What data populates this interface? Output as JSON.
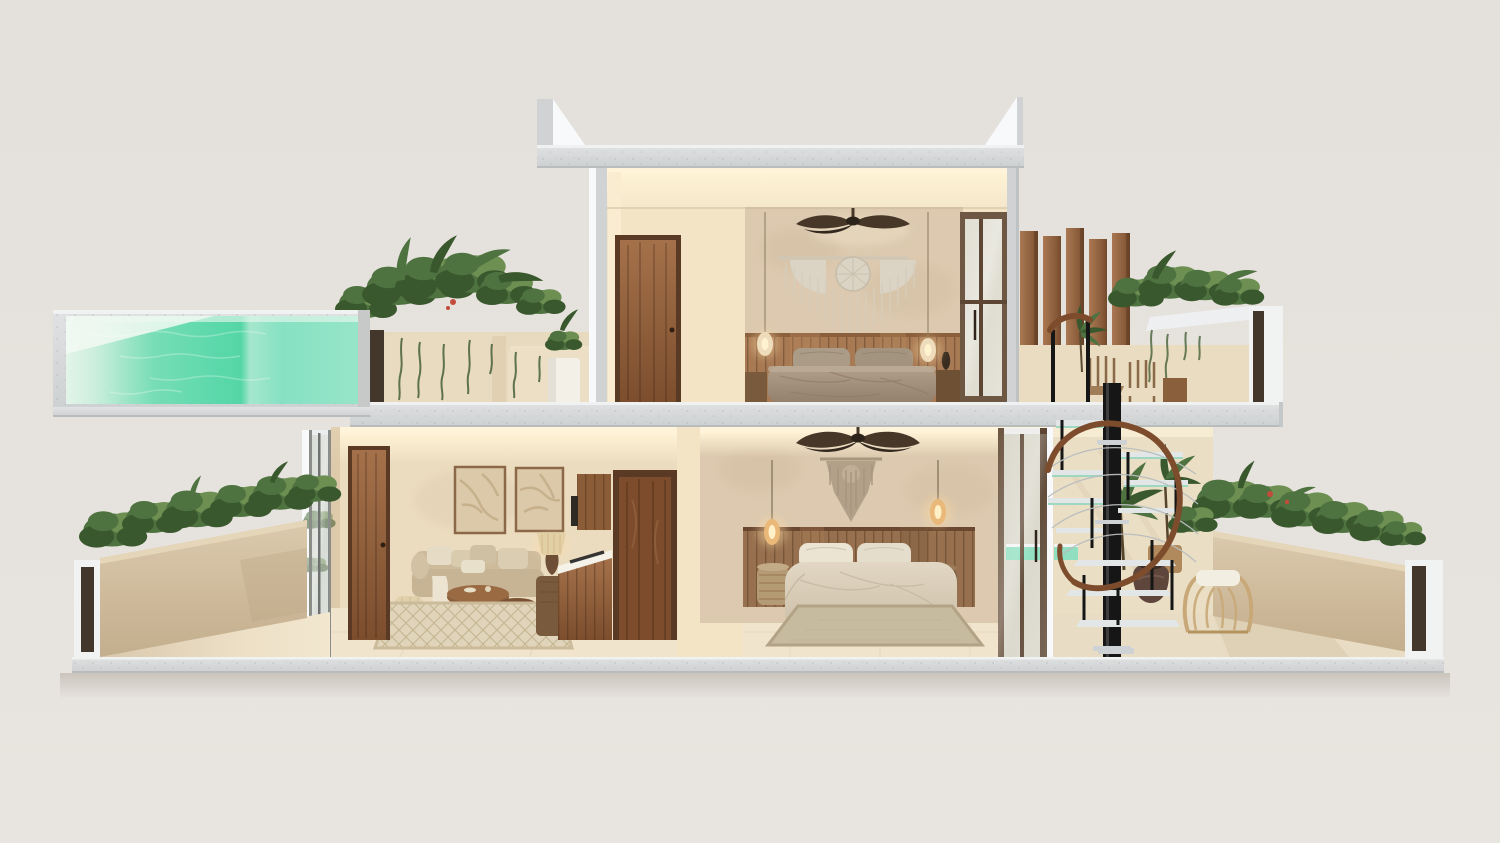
{
  "scene": {
    "type": "architectural-cutaway-render",
    "subject": "Two-story tropical villa cross-section (dollhouse view) on plain warm-gray backdrop",
    "canvas": {
      "width": 1500,
      "height": 843
    },
    "style": "photorealistic render, warm beige plaster, walnut wood, concrete slabs, lush plants",
    "areas": {
      "pool": {
        "label": "Elevated lap pool wing (left, upper level)",
        "objects": [
          "turquoise water",
          "concrete pool shell",
          "light reflection wedge"
        ]
      },
      "upperTerraceLeft": {
        "label": "Upper terrace with planters (left of upper bedroom)",
        "objects": [
          "stucco planter boxes",
          "trailing tropical plants",
          "white plant pot",
          "red flower accents",
          "shadow gap"
        ]
      },
      "upperBedroom": {
        "label": "Upper-floor bedroom (cutaway)",
        "objects": [
          "walnut door",
          "cove-lit ceiling",
          "ceiling fan",
          "macrame wall hanging",
          "wood plank wainscot",
          "double bed with taupe duvet",
          "two pendant lamps",
          "bedside tables",
          "bronze-framed glass slider"
        ]
      },
      "roof": {
        "label": "Concrete roof slab with cut parapet wedges"
      },
      "rooftopRight": {
        "label": "Rooftop terrace (right)",
        "objects": [
          "vertical walnut slat screen",
          "stucco parapet with concrete cap",
          "planter with greenery and hanging vines",
          "two wooden chairs",
          "potted palm",
          "stair handrail exit"
        ]
      },
      "livingRoom": {
        "label": "Ground-floor living room and kitchen (cutaway)",
        "objects": [
          "glass slider to garden",
          "walnut door",
          "two framed relief artworks",
          "beige sofa with cushions and throw",
          "round wooden nesting coffee tables",
          "woven pouf",
          "diamond-pattern rug",
          "table lamp on wood stump",
          "white kitchen counter with cooktop",
          "walnut cabinets",
          "tall walnut pantry door"
        ]
      },
      "lowerBedroom": {
        "label": "Ground-floor bedroom (cutaway)",
        "objects": [
          "ceiling fan",
          "macrame wall hanging",
          "wood plank wainscot",
          "double bed with cream duvet",
          "two amber pendant lamps",
          "drum side tables",
          "flatweave rug",
          "glass slider to stair court"
        ]
      },
      "leftTerrace": {
        "label": "Ground-floor garden terrace (left)",
        "objects": [
          "sloping stucco garden wall",
          "hedge planting",
          "white concrete end post",
          "sunlit stone floor"
        ]
      },
      "rightTerrace": {
        "label": "Ground-floor stair court and garden (right)",
        "objects": [
          "plunge pool glimpse",
          "clay pot",
          "potted palms and tropical plants",
          "rattan barrel chair with white cushion",
          "sloping stucco garden wall with hedge",
          "white concrete end post"
        ]
      },
      "spiralStair": {
        "label": "Black spiral staircase with glass treads and curved walnut handrail"
      },
      "structure": {
        "label": "Cast concrete floor and roof slabs with white cut faces"
      }
    }
  },
  "colors": {
    "bg": "#e5e1dc",
    "bg2": "#e8e4df",
    "slab": "#d7d9da",
    "slabEdge": "#f0f1f1",
    "slabShade": "#b9bcbd",
    "cutWhite": "#f8f9fa",
    "cutGray": "#d0d2d3",
    "wallBeige": "#ecdcbf",
    "wallLight": "#f3e4c6",
    "wallPlaster": "#dcc9af",
    "wallMottle": "#c9b394",
    "ceiling": "#f4e7cb",
    "cove": "#fff4da",
    "woodDoor": "#8a5836",
    "woodDoorDark": "#5a3a24",
    "woodTall": "#7c4c2c",
    "woodSlat": "#9d6c4b",
    "wainscotUp": "#a87a54",
    "wainscotLow": "#97704f",
    "plankLine": "#7a5336",
    "bedDuvetUp": "#a28e7b",
    "bedPillowUp": "#ab9c88",
    "bedDuvetLow": "#d7cbb6",
    "bedPillowLow": "#ebe4d3",
    "macrameUp": "#dbd3c3",
    "macrameLow": "#b3a088",
    "fan": "#463729",
    "pendant": "#eab879",
    "pendantGlow": "#ffdca3",
    "pool1": "#e3f4e9",
    "pool2": "#58d7a9",
    "pool3": "#9fe5cb",
    "glass": "#d4d9d3",
    "glassFrame": "#6e5844",
    "glassFrame2": "#5d4734",
    "sofa": "#c7b495",
    "sofaLight": "#e6dcc6",
    "rugLiving": "#e0d5ba",
    "rugPattern": "#b9a67f",
    "rugBed": "#c7bb9f",
    "tableWood": "#8a5f3c",
    "tableWoodDark": "#6f4a2c",
    "counter": "#f5f2ea",
    "cooktop": "#222222",
    "plant": "#4f7340",
    "plantDark": "#3a582e",
    "plantLight": "#6d8f52",
    "flower": "#c24b3a",
    "gardenWall": "#d2c0a2",
    "gardenWallDark": "#c2ad8c",
    "terraceFloor": "#e8dcc4",
    "floorInt": "#f0e5cc",
    "stair": "#161616",
    "tread": "#e3e6e6",
    "treadGlass": "#9fd8c0",
    "cable": "#b9bdbe",
    "rail": "#7d4c2c",
    "pot": "#5f463c",
    "rattan": "#c8a878",
    "cushion": "#f2eee2",
    "postWhite": "#f1f2f2",
    "slot": "#43372b",
    "artFrame": "#8a6848",
    "artFill": "#dcc9a9",
    "lamp": "#e3cfa4",
    "plinth": "#7a5a3c",
    "pouf": "#e0d0ab",
    "throw": "#ece4d0"
  }
}
